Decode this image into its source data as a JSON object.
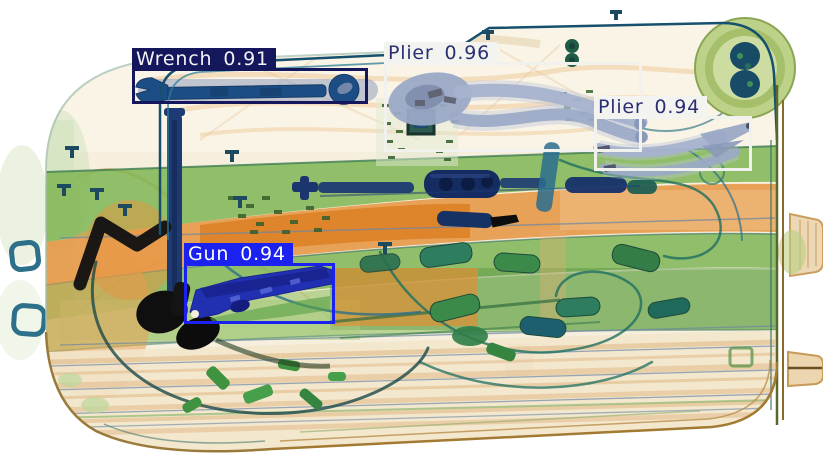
{
  "scene": {
    "type": "xray-baggage-scan",
    "background_color": "#ffffff",
    "case_fill": "#f7efdd",
    "strap_green": "#7fb554",
    "fabric_orange": "#e59440",
    "metal_blue": "#1c4e85",
    "plier_steel": "#9ba9c6"
  },
  "detections": [
    {
      "id": "wrench",
      "label": "Wrench",
      "score": "0.91",
      "box": {
        "x": 132,
        "y": 68,
        "w": 236,
        "h": 36
      },
      "box_color": "#15175c",
      "label_bg": "#15175c",
      "text_color": "#f2f2f7"
    },
    {
      "id": "plier-1",
      "label": "Plier",
      "score": "0.96",
      "box": {
        "x": 384,
        "y": 62,
        "w": 258,
        "h": 90
      },
      "box_color": "#f1f1ee",
      "label_bg": "#f3f3f0",
      "text_color": "#2b2f72"
    },
    {
      "id": "plier-2",
      "label": "Plier",
      "score": "0.94",
      "box": {
        "x": 594,
        "y": 116,
        "w": 158,
        "h": 55
      },
      "box_color": "#f1f1ee",
      "label_bg": "#f3f3f0",
      "text_color": "#2b2f72"
    },
    {
      "id": "gun",
      "label": "Gun",
      "score": "0.94",
      "box": {
        "x": 184,
        "y": 263,
        "w": 151,
        "h": 61
      },
      "box_color": "#1b22f0",
      "label_bg": "#1b22f0",
      "text_color": "#ffffff"
    }
  ]
}
